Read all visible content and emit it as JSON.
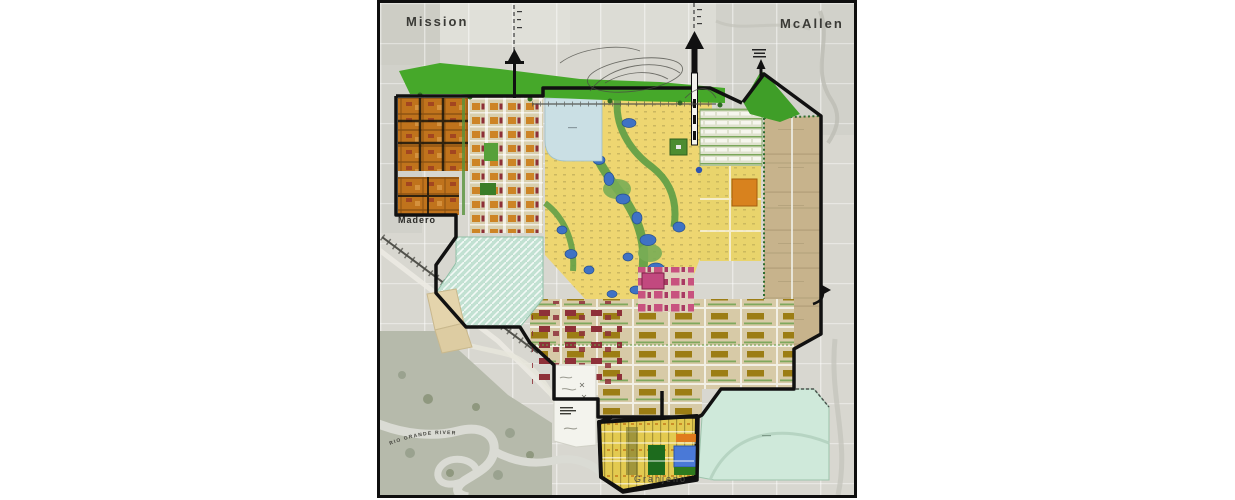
{
  "map": {
    "title": "Madero - Granjeno area master plan map",
    "labels": {
      "top_left_city": "Mission",
      "top_right_city": "McAllen",
      "left_village": "Madero",
      "bottom_village": "Granjeno",
      "river": "RIO GRANDE RIVER"
    },
    "palette": {
      "aerial_gray": "#d8d7d0",
      "aerial_dark": "#b6baab",
      "levee_green": "#46a82a",
      "residential_yellow": "#eed671",
      "village_orange": "#c0731c",
      "big_orange_parcel": "#d8821e",
      "pond_blue": "#3f72c4",
      "granjeno_blue": "#4a79d7",
      "canal_pale_blue": "#cadfe4",
      "tan_parcel": "#c7b38c",
      "flood_teal": "#cfe9da",
      "hatch_teal": "#c2e1d2",
      "pink_block": "#c8527f",
      "maroon_block": "#8e3038",
      "olive_block": "#9c7d14",
      "boundary_black": "#111111"
    }
  }
}
